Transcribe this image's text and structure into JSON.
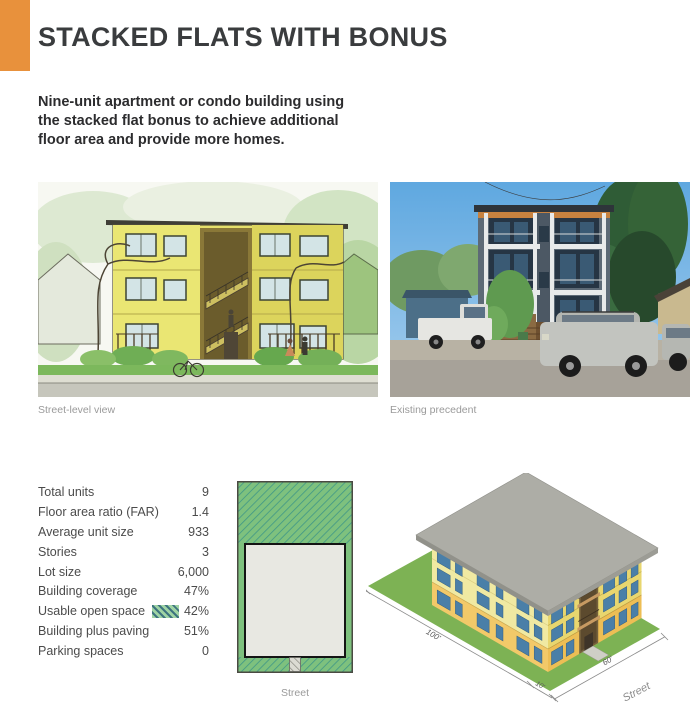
{
  "page": {
    "title": "STACKED FLATS WITH BONUS",
    "subtitle_lines": [
      "Nine-unit apartment or condo building using",
      "the stacked flat bonus to achieve additional",
      "floor area and provide more homes."
    ]
  },
  "figures": {
    "sketch_caption": "Street-level view",
    "photo_caption": "Existing precedent"
  },
  "stats": {
    "rows": [
      {
        "label": "Total units",
        "value": "9"
      },
      {
        "label": "Floor area ratio (FAR)",
        "value": "1.4"
      },
      {
        "label": "Average unit size",
        "value": "933"
      },
      {
        "label": "Stories",
        "value": "3"
      },
      {
        "label": "Lot size",
        "value": "6,000"
      },
      {
        "label": "Building coverage",
        "value": "47%"
      },
      {
        "label": "Usable open space",
        "value": "42%"
      },
      {
        "label": "Building plus paving",
        "value": "51%"
      },
      {
        "label": "Parking spaces",
        "value": "0"
      }
    ],
    "open_space_swatch": "green-diagonal-hatch"
  },
  "site_plan": {
    "street_label": "Street"
  },
  "axon": {
    "dim_depth": "100'",
    "dim_width": "60'",
    "dim_setback": "10'",
    "street_label": "Street"
  },
  "colors": {
    "accent_orange": "#E8913C",
    "open_space_green": "#7EC17E",
    "hatch_teal": "#3F9787",
    "footprint_gray": "#E8E8E2",
    "lot_green": "#7DB254",
    "roof_gray": "#ADADA6",
    "building_yellow": "#F0E9A2",
    "building_orange": "#F2C969",
    "window_blue": "#4A7FA8"
  }
}
